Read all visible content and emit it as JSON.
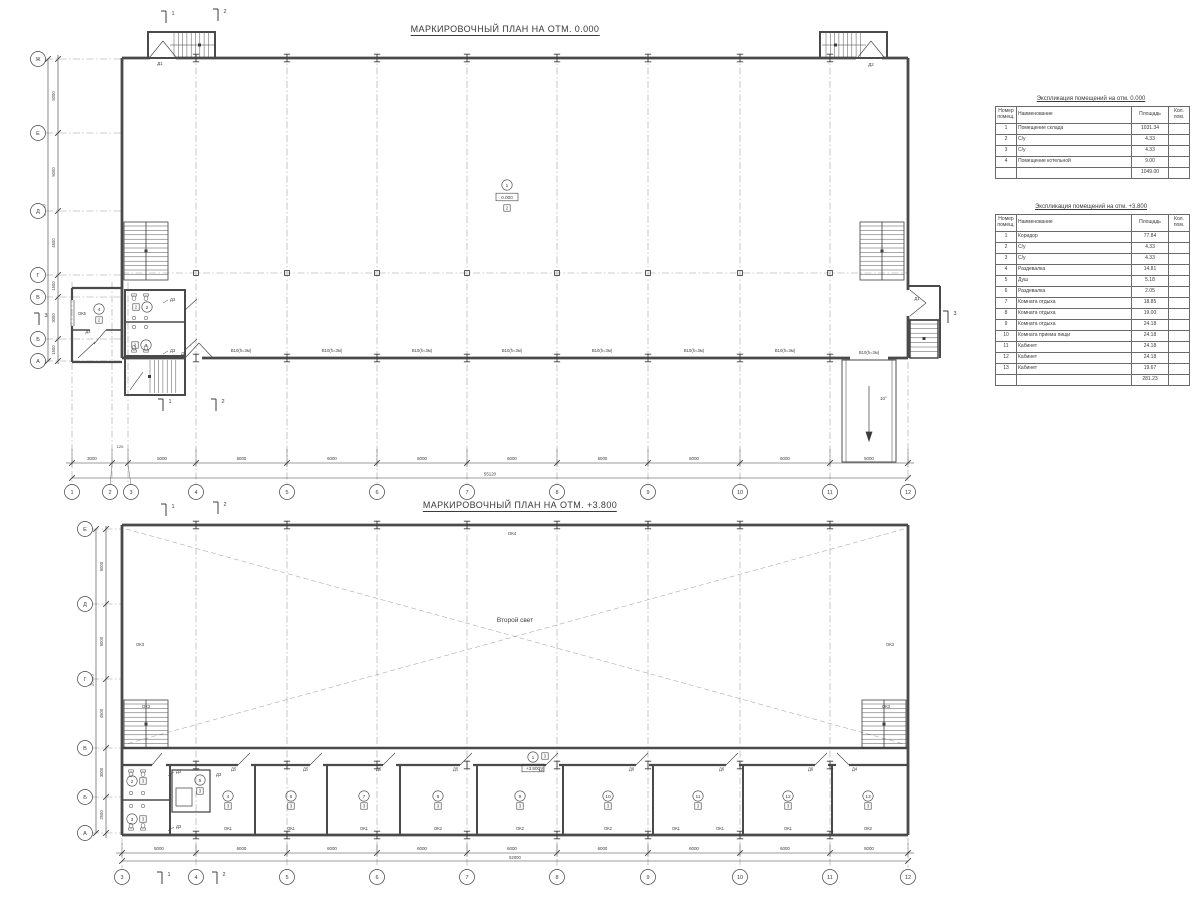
{
  "page": {
    "ink": "#3d3d3d",
    "wall": "#4a4a4a",
    "light": "#9a9a9a"
  },
  "plan1": {
    "title": "МАРКИРОВОЧНЫЙ ПЛАН НА ОТМ. 0.000",
    "grid_rows": [
      "Ж",
      "Е",
      "Д",
      "Г",
      "В",
      "Б",
      "А"
    ],
    "row_dims": [
      "5000",
      "5000",
      "4500",
      "1500",
      "3000",
      "1500"
    ],
    "row_total": "20000",
    "grid_cols": [
      "1",
      "2",
      "3",
      "4",
      "5",
      "6",
      "7",
      "8",
      "9",
      "10",
      "11",
      "12"
    ],
    "col_dims": [
      "3000",
      "120",
      "5000",
      "6000",
      "6000",
      "6000",
      "6000",
      "6000",
      "6000",
      "6000",
      "5000"
    ],
    "col_total": "55120",
    "main_room": {
      "number": "1",
      "elevation": "0.000",
      "finish": "2"
    },
    "boiler_room": {
      "number": "4",
      "finish": "2",
      "window": "ОК5",
      "door": "Д4"
    },
    "wc_top": {
      "number": "2",
      "finish": "2",
      "door": "Д3"
    },
    "wc_bottom": {
      "number": "3",
      "finish": "2",
      "door": "Д3"
    },
    "window_label": "В10(h=3м)",
    "door_top_left": "Д1",
    "door_top_right": "Д2",
    "door_bottom_left": "Д1",
    "door_right": "Д1",
    "ramp_angle": "10°",
    "section_marks": {
      "s1": "1",
      "s2": "2",
      "s3": "3"
    }
  },
  "plan2": {
    "title": "МАРКИРОВОЧНЫЙ ПЛАН НА ОТМ. +3.800",
    "grid_rows": [
      "Е",
      "Д",
      "Г",
      "В",
      "Б",
      "А"
    ],
    "row_dims": [
      "5000",
      "5000",
      "4500",
      "3000",
      "2500"
    ],
    "row_total": "20000",
    "grid_cols": [
      "3",
      "4",
      "5",
      "6",
      "7",
      "8",
      "9",
      "10",
      "11",
      "12"
    ],
    "col_dims": [
      "5000",
      "6000",
      "6000",
      "6000",
      "6000",
      "6000",
      "6000",
      "6000",
      "5000"
    ],
    "col_total": "52000",
    "void_label": "Второй свет",
    "top_window": "ОК4",
    "side_window": "ОК3",
    "corridor": {
      "number": "1",
      "finish": "3",
      "elevation": "+3.800"
    },
    "wc_top": {
      "number": "2",
      "finish": "3",
      "door": "Д3"
    },
    "wc_bottom": {
      "number": "3",
      "finish": "3",
      "door": "Д3"
    },
    "shower_room": {
      "number": "5",
      "finish": "3",
      "door": "Д3"
    },
    "rooms": [
      {
        "number": "4",
        "finish": "3",
        "windows": [
          "ОК1"
        ],
        "door": "Д5"
      },
      {
        "number": "6",
        "finish": "3",
        "windows": [
          "ОК1"
        ],
        "door": "Д5"
      },
      {
        "number": "7",
        "finish": "3",
        "windows": [
          "ОК1"
        ],
        "door": "Д5"
      },
      {
        "number": "8",
        "finish": "3",
        "windows": [
          "ОК2"
        ],
        "door": "Д5"
      },
      {
        "number": "9",
        "finish": "3",
        "windows": [
          "ОК2"
        ],
        "door": "Д5"
      },
      {
        "number": "10",
        "finish": "3",
        "windows": [
          "ОК2"
        ],
        "door": "Д6"
      },
      {
        "number": "11",
        "finish": "3",
        "windows": [
          "ОК1",
          "ОК1"
        ],
        "door": "Д6"
      },
      {
        "number": "12",
        "finish": "3",
        "windows": [
          "ОК1"
        ],
        "door": "Д6"
      },
      {
        "number": "13",
        "finish": "3",
        "windows": [
          "ОК2"
        ],
        "door": "Д4"
      }
    ],
    "section_marks": {
      "s1": "1",
      "s2": "2"
    }
  },
  "tables": [
    {
      "title": "Экспликация помещений на отм. 0.000",
      "headers": [
        "Номер помещ.",
        "Наименование",
        "Площадь",
        "Кол. пом."
      ],
      "rows": [
        [
          "1",
          "Помещение склада",
          "1031.34",
          ""
        ],
        [
          "2",
          "С/у",
          "4.33",
          ""
        ],
        [
          "3",
          "С/у",
          "4.33",
          ""
        ],
        [
          "4",
          "Помещение котельной",
          "9.00",
          ""
        ]
      ],
      "total": "1049.00"
    },
    {
      "title": "Экспликация помещений на отм. +3.800",
      "headers": [
        "Номер помещ.",
        "Наименование",
        "Площадь",
        "Кол. пом."
      ],
      "rows": [
        [
          "1",
          "Коридор",
          "77.84",
          ""
        ],
        [
          "2",
          "С/у",
          "4.33",
          ""
        ],
        [
          "3",
          "С/у",
          "4.33",
          ""
        ],
        [
          "4",
          "Раздевалка",
          "14.81",
          ""
        ],
        [
          "5",
          "Душ",
          "5.18",
          ""
        ],
        [
          "6",
          "Раздевалка",
          "2.05",
          ""
        ],
        [
          "7",
          "Комната отдыха",
          "18.85",
          ""
        ],
        [
          "8",
          "Комната отдыха",
          "19.00",
          ""
        ],
        [
          "9",
          "Комната отдыха",
          "24.18",
          ""
        ],
        [
          "10",
          "Комната приема пищи",
          "24.18",
          ""
        ],
        [
          "11",
          "Кабинет",
          "24.18",
          ""
        ],
        [
          "12",
          "Кабинет",
          "24.18",
          ""
        ],
        [
          "13",
          "Кабинет",
          "19.67",
          ""
        ]
      ],
      "total": "281.23"
    }
  ]
}
